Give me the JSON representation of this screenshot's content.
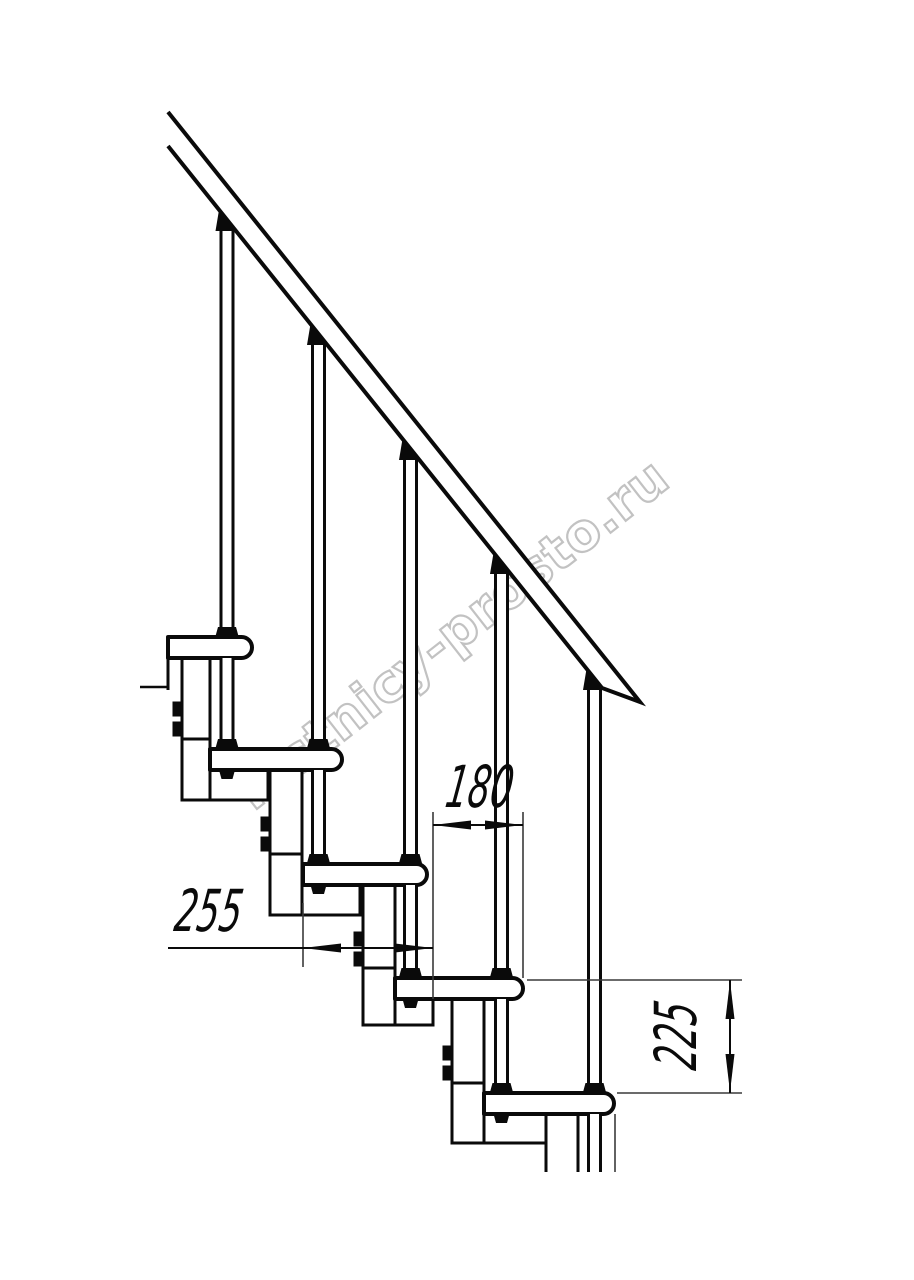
{
  "page": {
    "background": "#ffffff"
  },
  "drawing": {
    "subject": "modular staircase side elevation",
    "stroke_color": "#0a0a0a",
    "thin_line_color": "#3a3a3a",
    "counts": {
      "treads": 5,
      "balusters": 5,
      "support_columns": 5
    },
    "dimensions": {
      "tread_nose_spacing": {
        "value": "180",
        "orientation": "horizontal"
      },
      "step_run": {
        "value": "255",
        "orientation": "horizontal"
      },
      "step_rise": {
        "value": "225",
        "orientation": "vertical"
      }
    },
    "watermark": {
      "text": "lestnicy-prosto.ru",
      "color": "#c2c2c2"
    }
  }
}
